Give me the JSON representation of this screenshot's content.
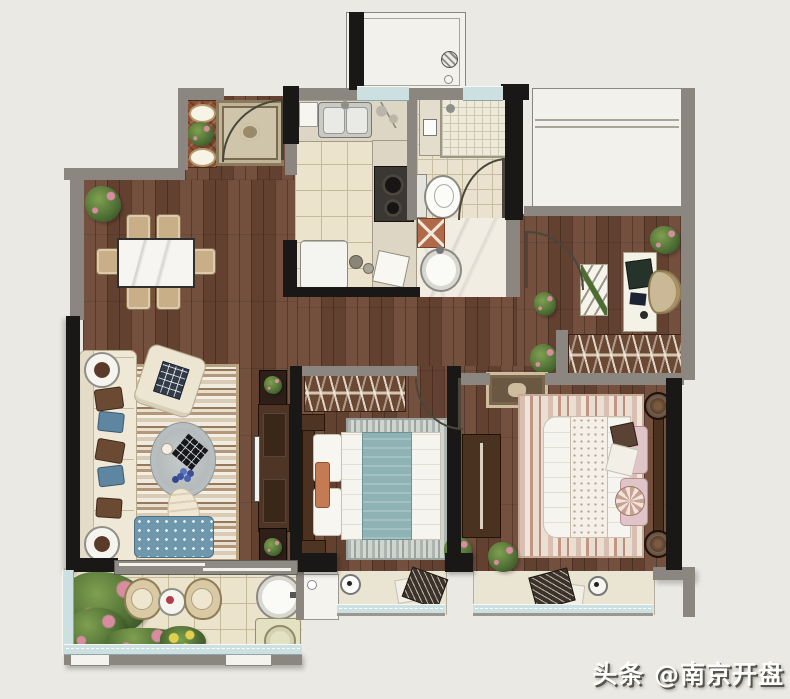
{
  "watermark": {
    "text": "头条 @南京开盘"
  },
  "palette": {
    "background": "#ebe9e3",
    "wall_dark": "#1a1816",
    "wall_gray": "#8b8780",
    "wood_floor": "#6b4635",
    "tile_floor": "#ece3cd",
    "window_glass": "#cde0e1",
    "sofa_cream": "#efe8d6",
    "accent_blue": "#6f98ac",
    "accent_teal": "#8fb2b5",
    "accent_pink": "#e0c4c8",
    "plant_green": "#4c6c33"
  },
  "rooms": [
    "entry",
    "dining-area",
    "living-room",
    "kitchen",
    "bathroom",
    "vanity",
    "corridor",
    "study-nook",
    "bedroom-middle",
    "bedroom-master",
    "balcony",
    "equipment-platform"
  ]
}
